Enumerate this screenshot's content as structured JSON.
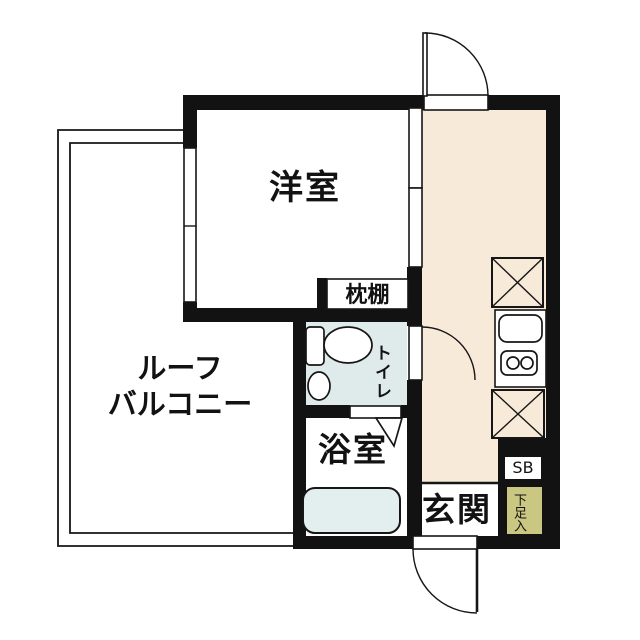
{
  "plan": {
    "type": "japanese-apartment-floor-plan",
    "labels": {
      "western_room": "洋室",
      "balcony_line1": "ルーフ",
      "balcony_line2": "バルコニー",
      "pillow_shelf": "枕棚",
      "toilet": "トイレ",
      "bathroom": "浴室",
      "entrance": "玄関",
      "shoe_box": "SB",
      "shoe_storage": "下足入"
    },
    "colors": {
      "wall": "#121212",
      "hall_floor": "#f7ead9",
      "wet_area": "#dfeaea",
      "bathtub": "#e3efee",
      "shoe_storage": "#c9c782",
      "line": "#161616"
    },
    "icons": [
      "crossed-box-icon",
      "kitchen-sink-icon",
      "two-burner-stove-icon",
      "toilet-bowl-icon",
      "hand-basin-icon",
      "bathtub-icon",
      "door-swing-arc-icon",
      "door-triangle-icon",
      "sliding-door-icon",
      "window-icon"
    ]
  }
}
